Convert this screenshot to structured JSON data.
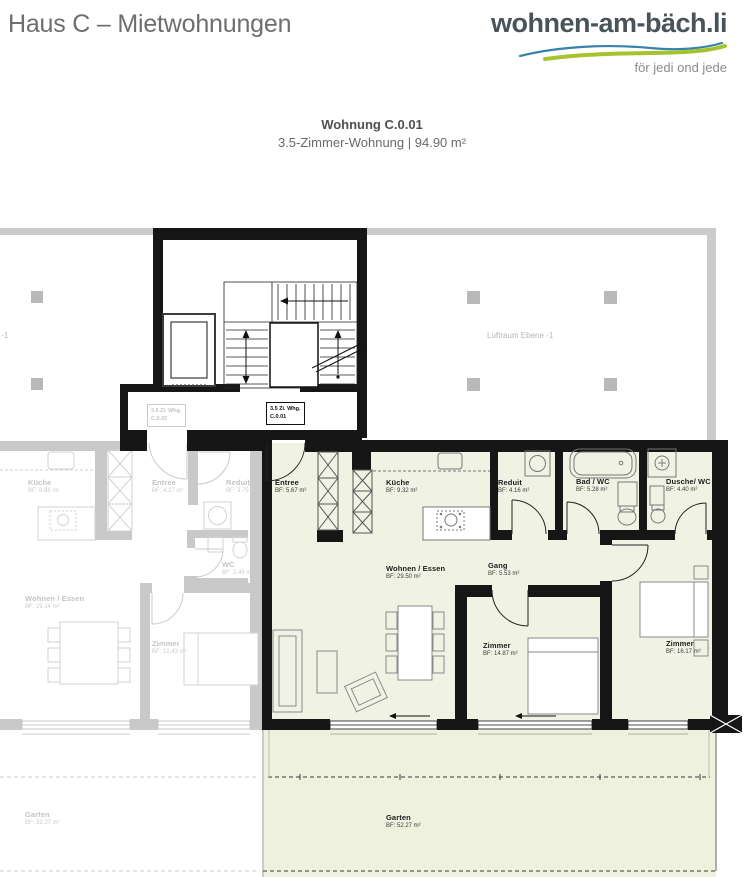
{
  "header": {
    "title": "Haus C – Mietwohnungen",
    "logo_text": "wohnen-am-bäch.li",
    "tagline": "för jedi ond jede"
  },
  "apartment": {
    "name": "Wohnung C.0.01",
    "details": "3.5-Zimmer-Wohnung | 94.90 m²"
  },
  "plan": {
    "unit_badges": {
      "active": {
        "line1": "3.5 Zi. Whg.",
        "line2": "C.0.01"
      },
      "neighbor": {
        "line1": "3.5 Zi. Whg.",
        "line2": "C.0.02"
      }
    },
    "void_label_right": "Luftraum Ebene -1",
    "void_label_left": "Luftraum Ebene -1",
    "active_rooms": [
      {
        "name": "Entree",
        "area": "BF: 5.67 m²"
      },
      {
        "name": "Küche",
        "area": "BF: 9.32 m²"
      },
      {
        "name": "Reduit",
        "area": "BF: 4.16 m²"
      },
      {
        "name": "Bad / WC",
        "area": "BF: 5.28 m²"
      },
      {
        "name": "Dusche/ WC",
        "area": "BF: 4.40 m²"
      },
      {
        "name": "Wohnen / Essen",
        "area": "BF: 29.50 m²"
      },
      {
        "name": "Gang",
        "area": "BF: 5.53 m²"
      },
      {
        "name": "Zimmer",
        "area": "BF: 14.87 m²"
      },
      {
        "name": "Zimmer",
        "area": "BF: 16.17 m²"
      },
      {
        "name": "Garten",
        "area": "BF: 52.27 m²"
      }
    ],
    "neighbor_rooms": [
      {
        "name": "Küche",
        "area": "BF: 8.86 m²"
      },
      {
        "name": "Entree",
        "area": "BF: 4.27 m²"
      },
      {
        "name": "Reduit",
        "area": "BF: 3.75 m²"
      },
      {
        "name": "WC",
        "area": "BF: 2.45 m²"
      },
      {
        "name": "Wohnen / Essen",
        "area": "BF: 29.14 m²"
      },
      {
        "name": "Zimmer",
        "area": "BF: 12.43 m²"
      },
      {
        "name": "Garten",
        "area": "BF: 32.27 m²"
      }
    ]
  },
  "colors": {
    "logo_text": "#48545a",
    "wave_blue": "#3583ab",
    "wave_green": "#a6c32f",
    "highlight_fill": "#f0f3e4",
    "garden_fill": "#edf1de",
    "wall_black": "#161616",
    "neighbor_gray": "#c9c9c9"
  }
}
